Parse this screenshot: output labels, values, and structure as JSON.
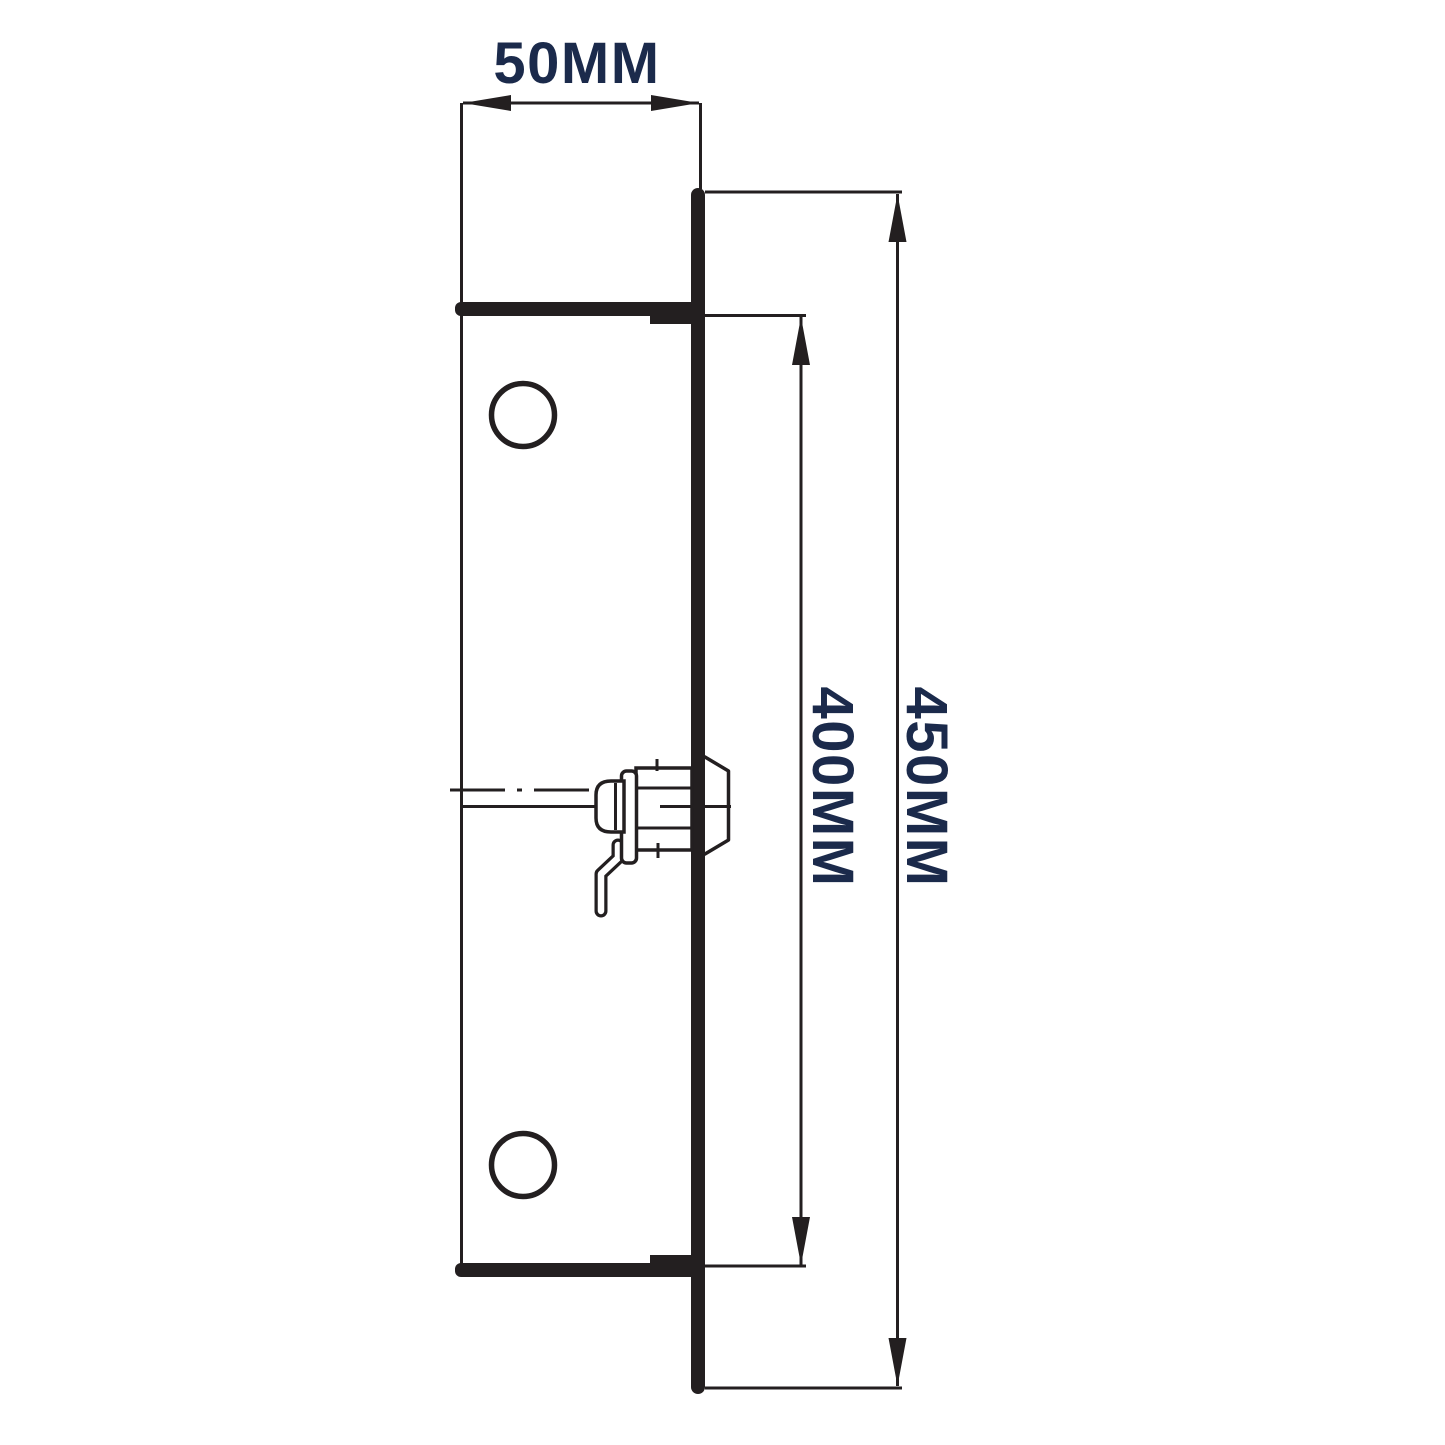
{
  "colors": {
    "line": "#231f20",
    "label": "#1b2a4b",
    "bg": "#ffffff"
  },
  "diagram": {
    "type": "technical-drawing",
    "subject": "Side profile of lock bracket with mounting flange plate, two fixing holes and cam bolt mechanism",
    "dimensions": {
      "width": "50MM",
      "inner_height": "400MM",
      "overall_height": "450MM"
    }
  }
}
